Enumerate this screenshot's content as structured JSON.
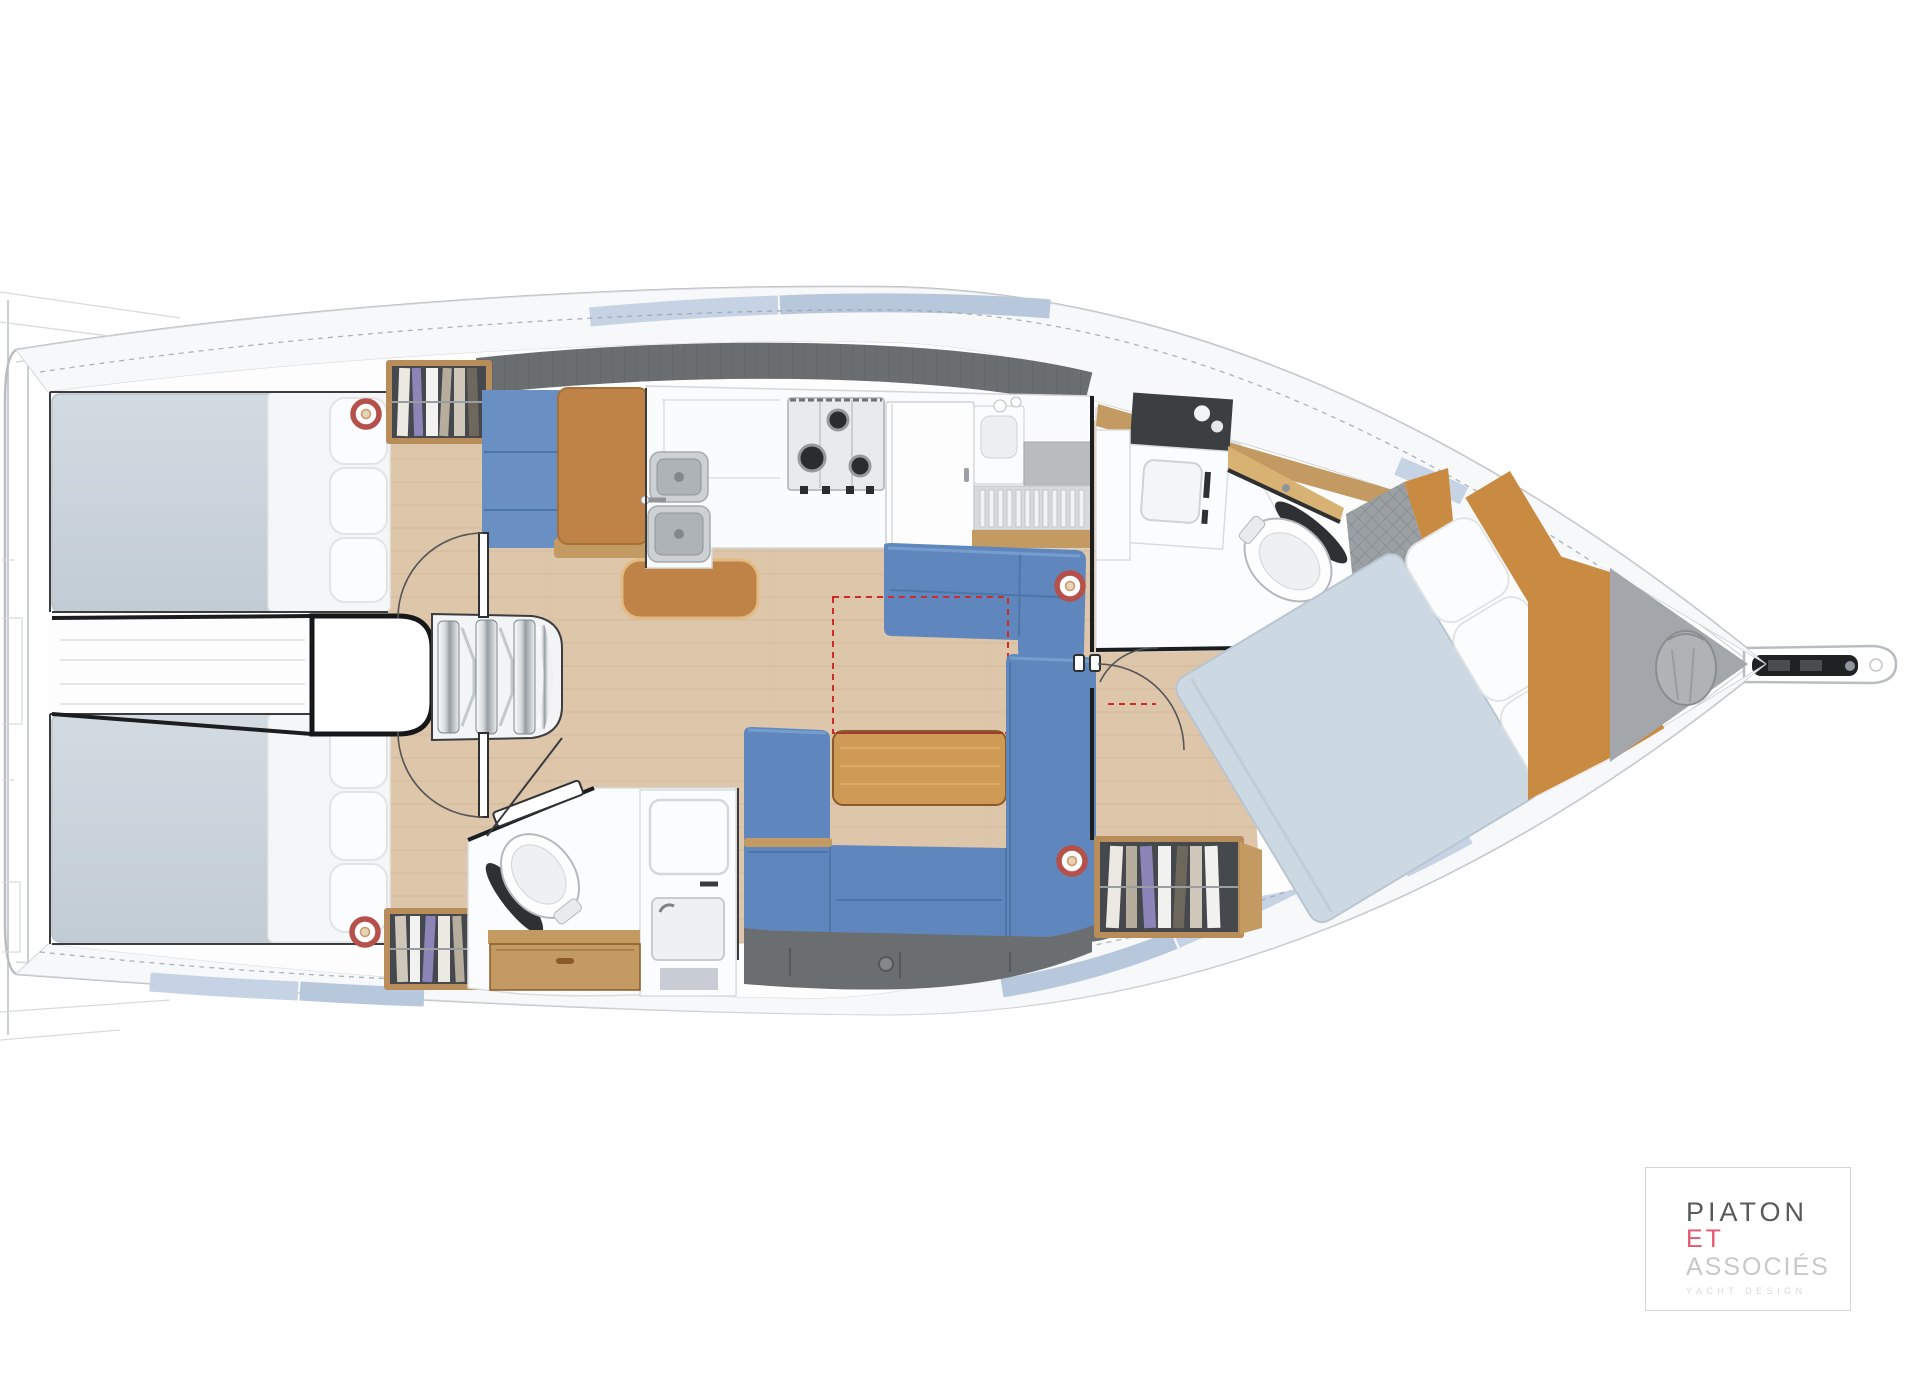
{
  "brand": {
    "name_line1": "PIATON",
    "name_line2": "ET",
    "name_line3": "ASSOCIÉS",
    "tagline": "YACHT DESIGN"
  },
  "colors": {
    "hullLine": "#b9bdc1",
    "deck": "#f6f8fa",
    "deckLine": "#d3d7da",
    "deckBlue1": "#c6d3e5",
    "deckBlue2": "#b7c8dc",
    "ink": "#1c1d1e",
    "wood": "#ddc6aa",
    "woodLine": "#cdb293",
    "woodTrim": "#c49a63",
    "tableWood": "#cf9a55",
    "woodPanel": "#c98a42",
    "leather": "#bf8347",
    "blue": "#5f87bd",
    "blueDark": "#4d76a8",
    "navBlue": "#6a8fc2",
    "mattress": "#cbd4dc",
    "vberth": "#ccd8e2",
    "darkGray": "#6b6e71",
    "quilt": "#9ba0a4",
    "lockerDark": "#45484c",
    "speakerRed": "#b5504b",
    "dashRed": "#cf2b2b",
    "logoDark": "#58595b",
    "logoPink": "#e8566d",
    "logoGray": "#c7c8ca",
    "logoFaint": "#d8d9da",
    "logoBorder": "#d4d5d7"
  }
}
